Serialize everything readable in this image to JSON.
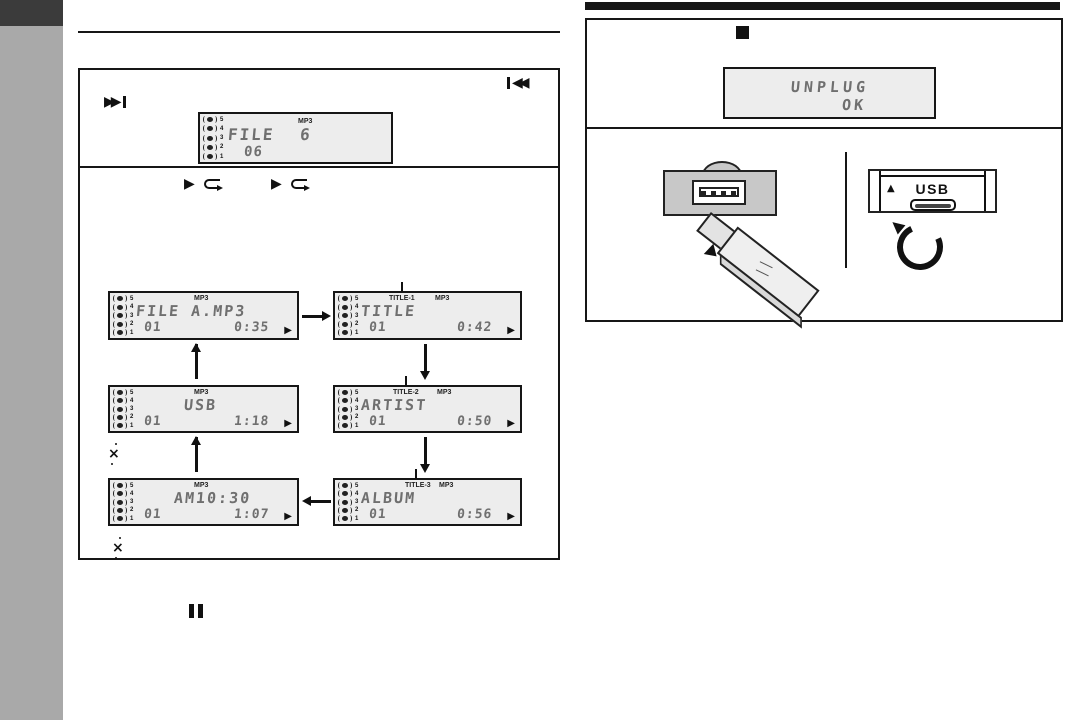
{
  "colors": {
    "sidebar": "#a9a9a9",
    "sidebar_tab": "#3b3b3b",
    "ink": "#161616",
    "lcd_background": "#ededed",
    "lcd_ink": "#6f6f6f",
    "panel_gray": "#c8c8c8"
  },
  "icons": {
    "skip_forward": "▶▶",
    "skip_back": "◀◀",
    "play": "▶",
    "stop": "■",
    "pause": "❚❚",
    "eject": "▲",
    "loop": "⊂",
    "footnote_marker": "×"
  },
  "lcd_common": {
    "source_numbers": [
      "5",
      "4",
      "3",
      "2",
      "1"
    ],
    "mp3_label": "MP3",
    "play_icon": "▶"
  },
  "left_column": {
    "skip_box": {
      "lcd_file": {
        "mp3_label": "MP3",
        "main": "FILE 6",
        "sub": "06"
      }
    },
    "flow_box": {
      "lcds": {
        "file": {
          "mp3_label": "MP3",
          "main": "FILE A.MP3",
          "track": "01",
          "time": "0:35"
        },
        "title": {
          "tag_label": "TITLE-1",
          "mp3_label": "MP3",
          "main": "TITLE",
          "track": "01",
          "time": "0:42"
        },
        "artist": {
          "tag_label": "TITLE-2",
          "mp3_label": "MP3",
          "main": "ARTIST",
          "track": "01",
          "time": "0:50"
        },
        "album": {
          "tag_label": "TITLE-3",
          "mp3_label": "MP3",
          "main": "ALBUM",
          "track": "01",
          "time": "0:56"
        },
        "clock": {
          "mp3_label": "MP3",
          "main": "AM10:30",
          "track": "01",
          "time": "1:07"
        },
        "usb": {
          "mp3_label": "MP3",
          "main": "USB",
          "track": "01",
          "time": "1:18"
        }
      }
    }
  },
  "right_column": {
    "lcd_unplug": {
      "line1": "UNPLUG",
      "line2": "OK"
    },
    "usb_panel": {
      "eject_triangle": "▲",
      "usb_label": "USB"
    }
  }
}
